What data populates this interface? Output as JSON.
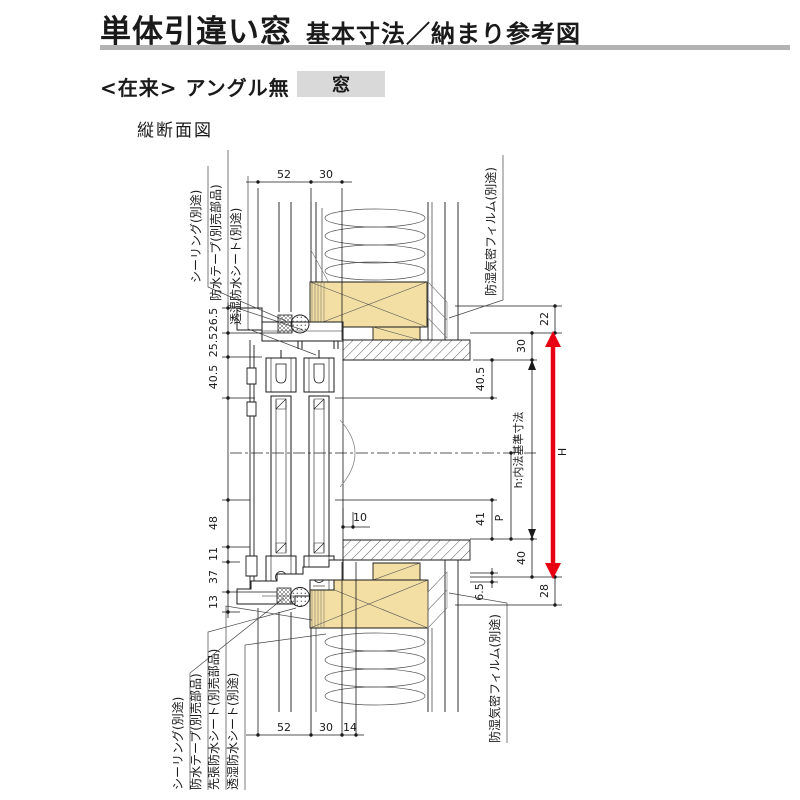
{
  "header": {
    "title": "単体引違い窓",
    "subtitle": "基本寸法／納まり参考図",
    "variant": "<在来> アングル無",
    "variant_tag": "窓",
    "drawing_label": "縦断面図"
  },
  "ann": {
    "top": [
      "シーリング(別途)",
      "防水テープ(別売部品)",
      "透湿防水シート(別途)",
      "防湿気密フィルム(別途)"
    ],
    "bottom": [
      "シーリング(別途)",
      "防水テープ(別売部品)",
      "先張防水シート(別売部品)",
      "透湿防水シート(別途)",
      "防湿気密フィルム(別途)"
    ]
  },
  "dims": {
    "top_52": "52",
    "top_30": "30",
    "bot_52": "52",
    "bot_30": "30",
    "bot_14": "14",
    "left_265": "26.5",
    "left_255": "25.5",
    "left_405": "40.5",
    "left_48": "48",
    "left_11": "11",
    "left_37": "37",
    "left_13": "13",
    "right_22": "22",
    "right_30": "30",
    "right_405": "40.5",
    "right_41": "41",
    "right_p": "P",
    "right_40": "40",
    "right_65": "6.5",
    "right_28": "28",
    "h_note": "h:内法基準寸法",
    "h_arrow": "H",
    "mid_10": "10"
  },
  "colors": {
    "wood": "#f3dfa4",
    "accent_red": "#e60012",
    "rule_gray": "#b3b3b3",
    "tag_bg": "#d9d9d9"
  }
}
